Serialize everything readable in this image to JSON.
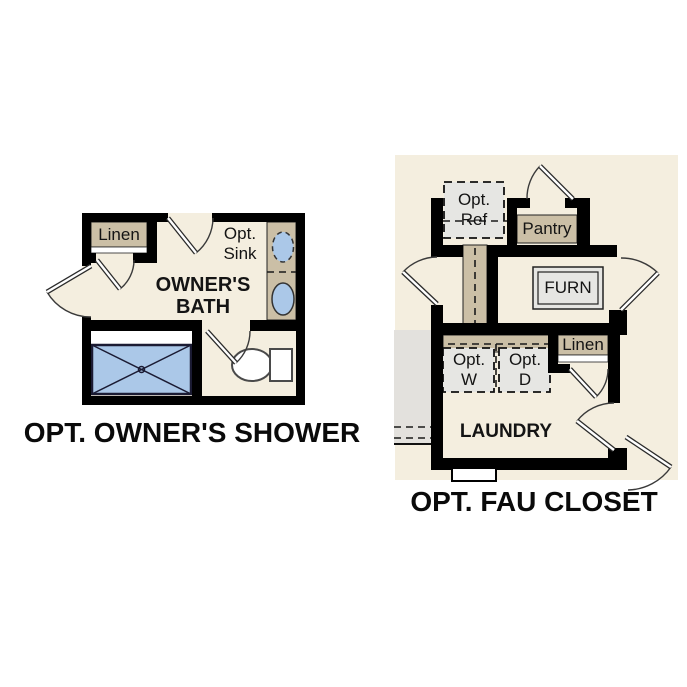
{
  "colors": {
    "floor": "#f4eedf",
    "cabinet_tan": "#cbbfa6",
    "appliance_gray": "#e6e6e3",
    "fixture_blue": "#abc8e8",
    "outside_gray": "#e3e1dd",
    "wall_black": "#000000"
  },
  "plans": {
    "owners_shower": {
      "title": "OPT. OWNER'S SHOWER",
      "room_label_line1": "OWNER'S",
      "room_label_line2": "BATH",
      "linen_label": "Linen",
      "opt_sink_line1": "Opt.",
      "opt_sink_line2": "Sink"
    },
    "fau_closet": {
      "title": "OPT. FAU CLOSET",
      "room_label": "LAUNDRY",
      "opt_ref_line1": "Opt.",
      "opt_ref_line2": "Ref",
      "pantry_label": "Pantry",
      "furn_label": "FURN",
      "linen_label": "Linen",
      "opt_w_line1": "Opt.",
      "opt_w_line2": "W",
      "opt_d_line1": "Opt.",
      "opt_d_line2": "D"
    }
  }
}
